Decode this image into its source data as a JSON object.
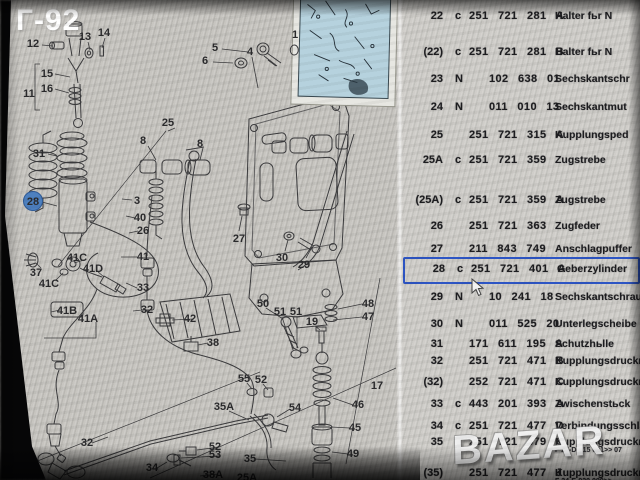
{
  "window": {
    "corner_label": "Г-92",
    "watermark": "BAZAR"
  },
  "table": {
    "rows": [
      {
        "pos": "22",
        "code": "c",
        "part": "251 721 281",
        "suffix": "A",
        "name": "Halter fьr N"
      },
      {
        "pos": "(22)",
        "code": "c",
        "part": "251 721 281",
        "suffix": "B",
        "name": "Halter fьr N"
      },
      {
        "pos": "23",
        "code": "N",
        "part": "102 638 01",
        "suffix": "",
        "name": "Sechskantschr",
        "indent": true
      },
      {
        "pos": "24",
        "code": "N",
        "part": "011 010 13",
        "suffix": "",
        "name": "Sechskantmut",
        "indent": true
      },
      {
        "pos": "25",
        "code": "",
        "part": "251 721 315",
        "suffix": "A",
        "name": "Kupplungsped"
      },
      {
        "pos": "25A",
        "code": "c",
        "part": "251 721 359",
        "suffix": "",
        "name": "Zugstrebe"
      },
      {
        "pos": "(25A)",
        "code": "c",
        "part": "251 721 359",
        "suffix": "A",
        "name": "Zugstrebe"
      },
      {
        "pos": "26",
        "code": "",
        "part": "251 721 363",
        "suffix": "",
        "name": "Zugfeder"
      },
      {
        "pos": "27",
        "code": "",
        "part": "211 843 749",
        "suffix": "",
        "name": "Anschlagpuffer"
      },
      {
        "pos": "28",
        "code": "c",
        "part": "251 721 401",
        "suffix": "A",
        "name": "Geberzylinder",
        "selected": true
      },
      {
        "pos": "29",
        "code": "N",
        "part": "10 241 18",
        "suffix": "",
        "name": "Sechskantschraube",
        "indent": true
      },
      {
        "pos": "30",
        "code": "N",
        "part": "011 525 20",
        "suffix": "",
        "name": "Unterlegscheibe",
        "indent": true
      },
      {
        "pos": "31",
        "code": "",
        "part": "171 611 195",
        "suffix": "A",
        "name": "Schutzhьlle"
      },
      {
        "pos": "32",
        "code": "",
        "part": "251 721 471",
        "suffix": "B",
        "name": "Kupplungsdruckrohr"
      },
      {
        "pos": "(32)",
        "code": "",
        "part": "252 721 471",
        "suffix": "C",
        "name": "Kupplungsdruckrohr"
      },
      {
        "pos": "33",
        "code": "c",
        "part": "443 201 393",
        "suffix": "A",
        "name": "Zwischenstьck"
      },
      {
        "pos": "34",
        "code": "c",
        "part": "251 721 477",
        "suffix": "D",
        "name": "Verbindungsschlauch"
      },
      {
        "pos": "35",
        "code": "",
        "part": "251 721 479",
        "suffix": "C",
        "name": "Kupplungsdruckrohr",
        "note": "F 24-D-015 001>>  07"
      },
      {
        "pos": "(35)",
        "code": "",
        "part": "251 721 477",
        "suffix": "J",
        "name": "Kupplungsdruckrohr",
        "note": "F 24-E-020 000>>"
      }
    ]
  },
  "diagram": {
    "labels": [
      {
        "t": "12",
        "x": 33,
        "y": 43
      },
      {
        "t": "13",
        "x": 85,
        "y": 36
      },
      {
        "t": "14",
        "x": 104,
        "y": 32
      },
      {
        "t": "15",
        "x": 47,
        "y": 73
      },
      {
        "t": "16",
        "x": 47,
        "y": 88
      },
      {
        "t": "11",
        "x": 29,
        "y": 93
      },
      {
        "t": "5",
        "x": 215,
        "y": 47
      },
      {
        "t": "6",
        "x": 205,
        "y": 60
      },
      {
        "t": "4",
        "x": 250,
        "y": 51
      },
      {
        "t": "1",
        "x": 295,
        "y": 34
      },
      {
        "t": "25",
        "x": 168,
        "y": 122
      },
      {
        "t": "8",
        "x": 143,
        "y": 140
      },
      {
        "t": "8",
        "x": 200,
        "y": 143
      },
      {
        "t": "31",
        "x": 39,
        "y": 153
      },
      {
        "t": "28",
        "x": 33,
        "y": 201,
        "kind": "circle"
      },
      {
        "t": "3",
        "x": 137,
        "y": 200
      },
      {
        "t": "40",
        "x": 140,
        "y": 217
      },
      {
        "t": "26",
        "x": 143,
        "y": 230
      },
      {
        "t": "37",
        "x": 36,
        "y": 272
      },
      {
        "t": "41C",
        "x": 77,
        "y": 257
      },
      {
        "t": "41D",
        "x": 93,
        "y": 268
      },
      {
        "t": "41C",
        "x": 49,
        "y": 283
      },
      {
        "t": "41",
        "x": 143,
        "y": 256
      },
      {
        "t": "33",
        "x": 143,
        "y": 287
      },
      {
        "t": "41B",
        "x": 67,
        "y": 310,
        "kind": "box"
      },
      {
        "t": "41A",
        "x": 88,
        "y": 318
      },
      {
        "t": "32",
        "x": 147,
        "y": 309
      },
      {
        "t": "27",
        "x": 239,
        "y": 238
      },
      {
        "t": "30",
        "x": 282,
        "y": 257
      },
      {
        "t": "29",
        "x": 304,
        "y": 264
      },
      {
        "t": "50",
        "x": 263,
        "y": 303
      },
      {
        "t": "51",
        "x": 280,
        "y": 311
      },
      {
        "t": "51",
        "x": 296,
        "y": 311
      },
      {
        "t": "48",
        "x": 368,
        "y": 303
      },
      {
        "t": "47",
        "x": 368,
        "y": 316
      },
      {
        "t": "19",
        "x": 312,
        "y": 321
      },
      {
        "t": "42",
        "x": 190,
        "y": 318
      },
      {
        "t": "38",
        "x": 213,
        "y": 342
      },
      {
        "t": "55",
        "x": 244,
        "y": 378
      },
      {
        "t": "52",
        "x": 261,
        "y": 379
      },
      {
        "t": "35A",
        "x": 224,
        "y": 406
      },
      {
        "t": "54",
        "x": 295,
        "y": 407
      },
      {
        "t": "46",
        "x": 358,
        "y": 404
      },
      {
        "t": "45",
        "x": 355,
        "y": 427
      },
      {
        "t": "17",
        "x": 377,
        "y": 385
      },
      {
        "t": "52",
        "x": 215,
        "y": 446
      },
      {
        "t": "53",
        "x": 215,
        "y": 454
      },
      {
        "t": "35",
        "x": 250,
        "y": 458
      },
      {
        "t": "49",
        "x": 353,
        "y": 453
      },
      {
        "t": "32",
        "x": 87,
        "y": 442
      },
      {
        "t": "34",
        "x": 152,
        "y": 467
      },
      {
        "t": "38A",
        "x": 213,
        "y": 474
      },
      {
        "t": "25A",
        "x": 247,
        "y": 477
      }
    ]
  }
}
